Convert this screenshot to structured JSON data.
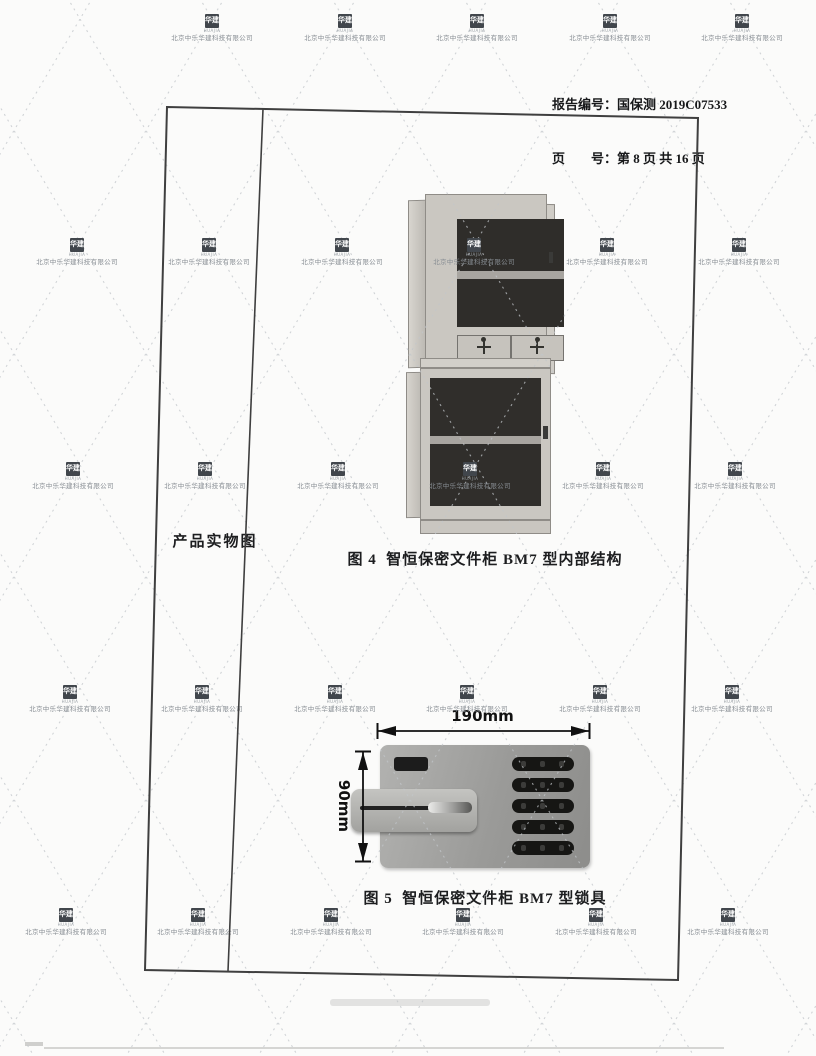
{
  "header": {
    "report_line": "报告编号：国保测 2019C07533",
    "page_line": "页　　号：第 8 页 共 16 页"
  },
  "watermark": {
    "company": "北京中乐华建科技有限公司",
    "logo": "华建",
    "logo_sub": "HUAJIA"
  },
  "panel": {
    "row_label": "产品实物图"
  },
  "figures": [
    {
      "caption": "图 4  智恒保密文件柜 BM7 型内部结构"
    },
    {
      "caption": "图 5  智恒保密文件柜 BM7 型锁具"
    }
  ],
  "lock_dimensions": {
    "width": "190mm",
    "height": "90mm"
  },
  "colors": {
    "frame_line": "#3f3f3f",
    "watermark_gray": "#878d93",
    "dimension_line": "#111111",
    "cabinet_body": "#cac7c1",
    "cabinet_interior": "#2f2d2a",
    "lock_panel": "#9a9a98"
  }
}
